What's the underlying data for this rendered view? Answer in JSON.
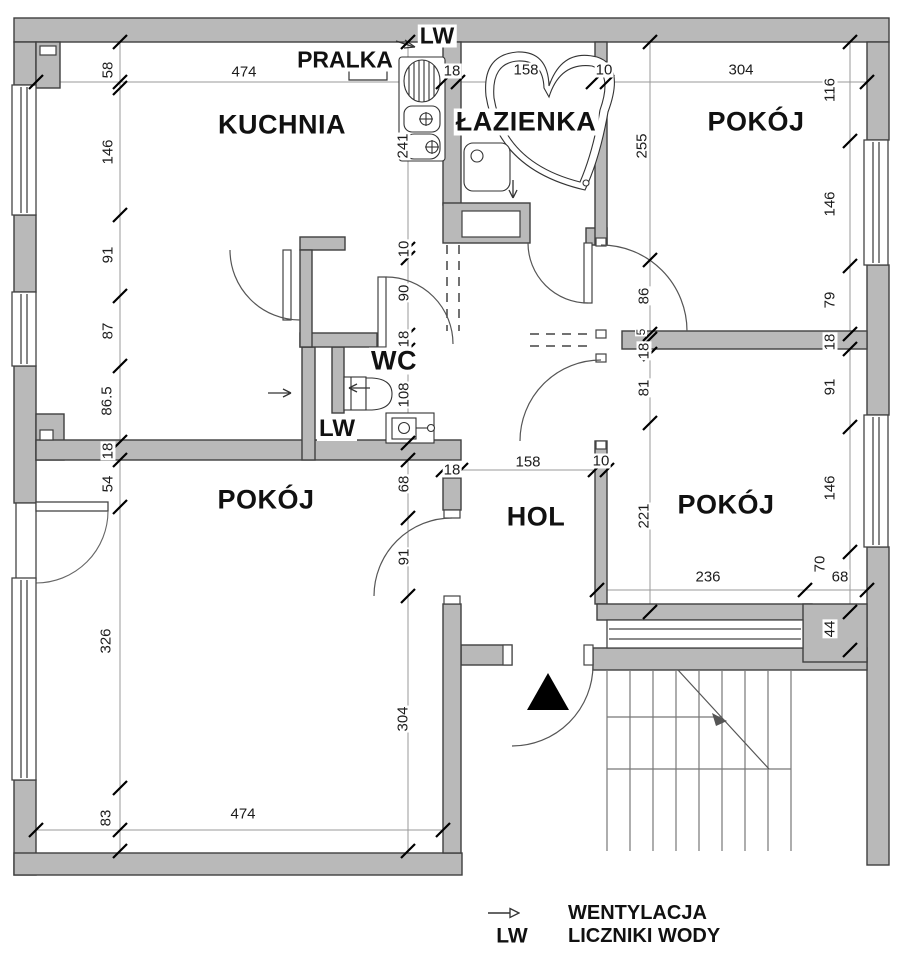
{
  "colors": {
    "wall_fill": "#b9b9b9",
    "wall_outline": "#3f3f3f",
    "background": "#ffffff"
  },
  "rooms": {
    "kitchen": "KUCHNIA",
    "bathroom": "ŁAZIENKA",
    "room_top_right": "POKÓJ",
    "wc": "WC",
    "hall": "HOL",
    "room_bottom_left": "POKÓJ",
    "room_bottom_right": "POKÓJ"
  },
  "annotations": {
    "washer": "PRALKA",
    "water_meter_top": "LW",
    "water_meter_wc": "LW"
  },
  "icons": {
    "ventilation": "small-open-arrow",
    "entrance_marker": "black-triangle",
    "stairs_direction": "diagonal-arrow"
  },
  "legend": {
    "ventilation": "WENTYLACJA",
    "water_meter_abbr": "LW",
    "water_meter": "LICZNIKI WODY"
  },
  "dims": {
    "d1": "58",
    "d2": "146",
    "d3": "91",
    "d4": "87",
    "d5": "86.5",
    "d6": "18",
    "d7": "54",
    "d8": "326",
    "d9": "83",
    "d10": "474",
    "d11": "18",
    "d12": "158",
    "d13": "10",
    "d14": "304",
    "d15": "116",
    "d16": "146",
    "d17": "79",
    "d18": "18",
    "d19": "91",
    "d20": "146",
    "d21": "241",
    "d22": "10",
    "d23": "90",
    "d24": "18",
    "d25": "108",
    "d26": "255",
    "d27": "86",
    "d28": "5",
    "d29": "18",
    "d30": "81",
    "d31": "221",
    "d32": "18",
    "d33": "158",
    "d34": "10",
    "d35": "68",
    "d36": "91",
    "d37": "304",
    "d38": "236",
    "d39": "70",
    "d40": "68",
    "d41": "44",
    "d42": "474"
  }
}
